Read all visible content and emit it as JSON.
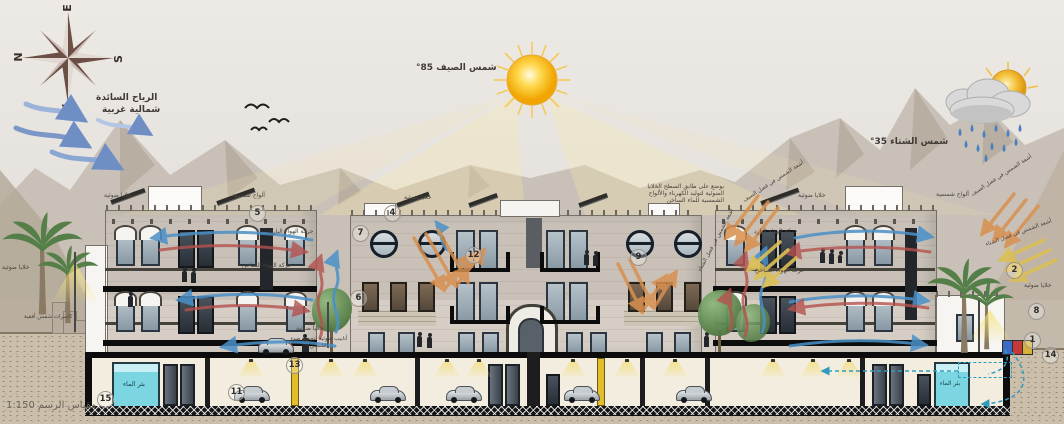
{
  "compass": {
    "n": "N",
    "e": "E",
    "s": "S",
    "w": "W"
  },
  "sky": {
    "wind_line1": "الرياح السائدة",
    "wind_line2": "شمالية غربية",
    "summer_sun": "شمس الصيف 85°",
    "winter_sun": "شمس الشتاء 35°"
  },
  "annotations": {
    "pv": "خلايا ضوئية",
    "solar": "ألواح شمسية",
    "cold": "حركة الهواء البارد",
    "hot": "حركة الهواء الساخن",
    "summer_ray": "أشعة الشمس في فصل الصيف",
    "winter_ray": "أشعة الشمس في فصل الشتاء",
    "roof_note": "يوضع على طابق السطح الخلايا الضوئية لتوليد الكهرباء والألواح الشمسية للماء الساخن",
    "tubes": "أنابيب ضوئية لتجميع ضوء الشمس",
    "breakers": "كاسرات شمس أفقية",
    "well": "بئر الماء",
    "scale": "مقياس الرسم 1:150"
  },
  "markers": {
    "m1": "1",
    "m2": "2",
    "m4": "4",
    "m5": "5",
    "m6": "6",
    "m7": "7",
    "m8": "8",
    "m9": "9",
    "m11": "11",
    "m12": "12",
    "m13": "13",
    "m14": "14",
    "m15": "15"
  },
  "colors": {
    "cold_air": "#4a90c8",
    "hot_air": "#b5524e",
    "summer_rays": "#d9904f",
    "winter_rays": "#dcbf55",
    "water_tank": "#7cd6e2",
    "sun": "#f9c842"
  }
}
